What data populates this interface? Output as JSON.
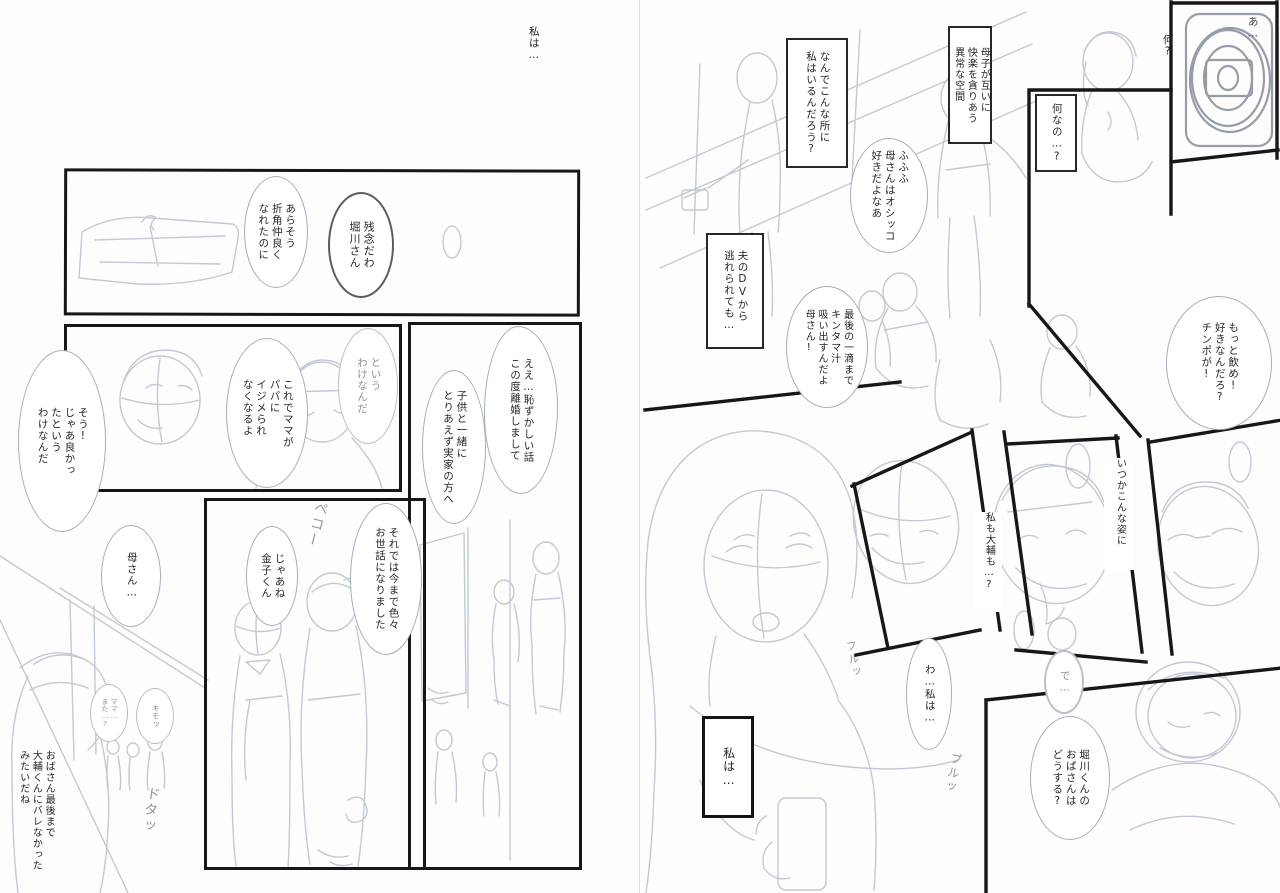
{
  "colors": {
    "paper": "#fdfdfd",
    "ink": "#17171a",
    "pencil_light": "#c3c9d4",
    "pencil_mid": "#aeb5c1",
    "pencil_heavy": "#969da9",
    "bubble_line": "#a6aeba"
  },
  "narration_top": "私は…",
  "left_page": {
    "panel1": {
      "bubble_arasou": "あらそう\n折角仲良く\nなれたのに",
      "bubble_zannen": "残念だわ\n堀川さん"
    },
    "panel2": {
      "bubble_toiuwake": "という\nわけなんだ",
      "bubble_koredemama": "これでママが\nパパに\nイジメられ\nなくなるよ",
      "bubble_sou": "そう!\nじゃあ良かっ\nたという\nわけなんだ"
    },
    "panel3": {
      "bubble_ee": "ええ…恥ずかしい話\nこの度離婚しまして",
      "bubble_kodomo": "子供と一緒に\nとりあえず実家の方へ"
    },
    "panel4": {
      "sfx_peko": "ペコー",
      "bubble_soredewa": "それでは今まで色々\nお世話になりました",
      "bubble_jaane": "じゃあね\n金子くん"
    },
    "hallway": {
      "bubble_kaasan": "母さん…",
      "bubble_mama_mata": "ママ…\nまた…?",
      "bubble_kimo": "キモッ",
      "sfx_dota": "ドタッ",
      "caption_obasan": "おばさん最後まで\n大輔くんにバレなかった\nみたいだね"
    }
  },
  "right_page": {
    "caption_nande": "なんでこんな所に\n私はいるんだろう?",
    "caption_boshi": "母子が互いに\n快楽を貪りあう\n異常な空間",
    "bubble_fufu": "ふふふ\n母さんはオシッコ\n好きだよなあ",
    "caption_nanino": "何なの…?",
    "text_nani": "何?",
    "text_a": "あ…",
    "caption_otto": "夫のDVから\n逃れられても…",
    "bubble_saigo": "最後の一滴まで\nキンタマ汁\n吸い出すんだよ\n母さん!",
    "bubble_motto": "もっと飲め!\n好きなんだろ?\nチンポが!",
    "text_watashimo": "私も大輔も…?",
    "text_itsuka": "いつかこんな姿に",
    "bubble_wa": "わ…私は…",
    "text_de": "で…",
    "sfx_furu": "フルッ",
    "sfx_buru": "ブルッ",
    "bubble_horikawa": "堀川くんの\nおばさんは\nどうする?",
    "caption_watashiwa": "私は…"
  }
}
